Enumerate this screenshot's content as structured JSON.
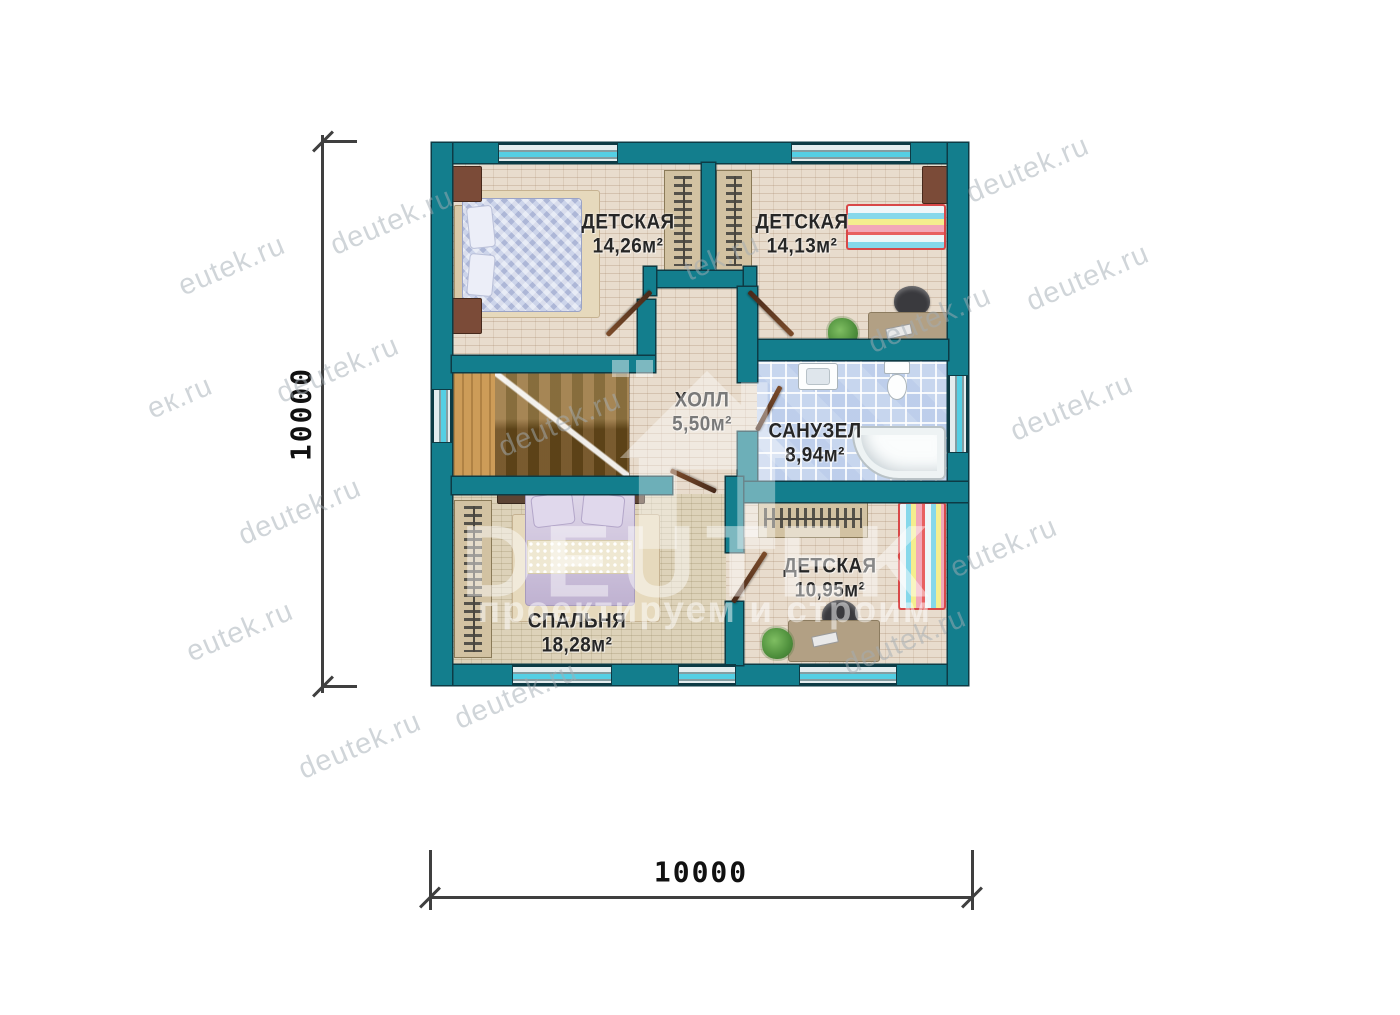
{
  "plan": {
    "rooms": [
      {
        "name": "ДЕТСКАЯ",
        "area": "14,26м²"
      },
      {
        "name": "ДЕТСКАЯ",
        "area": "14,13м²"
      },
      {
        "name": "ХОЛЛ",
        "area": "5,50м²"
      },
      {
        "name": "САНУЗЕЛ",
        "area": "8,94м²"
      },
      {
        "name": "СПАЛЬНЯ",
        "area": "18,28м²"
      },
      {
        "name": "ДЕТСКАЯ",
        "area": "10,95м²"
      }
    ],
    "dimensions": {
      "width": "10000",
      "height": "10000"
    }
  },
  "watermarks": {
    "logo": {
      "title": "DEUTEK",
      "subtitle": "проектируем и строим"
    },
    "items": [
      {
        "text": "eutek.ru",
        "x": 232,
        "y": 266
      },
      {
        "text": "ек.ru",
        "x": 180,
        "y": 398
      },
      {
        "text": "deutek.ru",
        "x": 300,
        "y": 512
      },
      {
        "text": "eutek.ru",
        "x": 240,
        "y": 632
      },
      {
        "text": "deutek.ru",
        "x": 360,
        "y": 746
      },
      {
        "text": "deutek.ru",
        "x": 392,
        "y": 222
      },
      {
        "text": "deutek.ru",
        "x": 338,
        "y": 370
      },
      {
        "text": "deutek.ru",
        "x": 516,
        "y": 696
      },
      {
        "text": "deutek.ru",
        "x": 560,
        "y": 424
      },
      {
        "text": "tek.ru",
        "x": 722,
        "y": 258
      },
      {
        "text": "deutek.ru",
        "x": 930,
        "y": 320
      },
      {
        "text": "deutek.ru",
        "x": 1088,
        "y": 278
      },
      {
        "text": "deutek.ru",
        "x": 1072,
        "y": 408
      },
      {
        "text": "eutek.ru",
        "x": 1004,
        "y": 548
      },
      {
        "text": "deutek.ru",
        "x": 1028,
        "y": 170
      },
      {
        "text": "deutek.ru",
        "x": 905,
        "y": 642
      }
    ]
  },
  "colors": {
    "wall": "#137e8d",
    "outline": "#0d3b45",
    "glass": "#54cfe4",
    "floor": "#e8dccd",
    "bath_tile": "#c7d6ee",
    "wood": "#8f6d3a",
    "dim": "#3f3f3f"
  }
}
